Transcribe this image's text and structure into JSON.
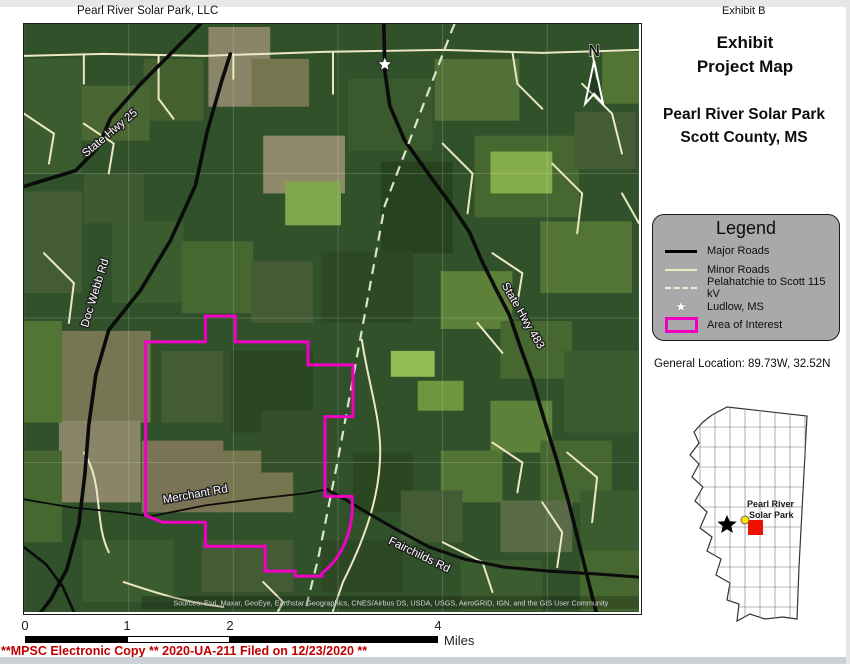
{
  "header": {
    "map_title": "Pearl River Solar Park, LLC",
    "exhibit_tag": "Exhibit B"
  },
  "panel": {
    "title_line1": "Exhibit",
    "title_line2": "Project Map",
    "subtitle_line1": "Pearl River Solar Park",
    "subtitle_line2": "Scott County, MS"
  },
  "legend": {
    "title": "Legend",
    "items": [
      {
        "label": "Major Roads",
        "symbol": "solid-black-line"
      },
      {
        "label": "Minor Roads",
        "symbol": "solid-cream-line"
      },
      {
        "label": "Pelahatchie to Scott 115 kV",
        "symbol": "dashed-pale-line"
      },
      {
        "label": "Ludlow, MS",
        "symbol": "white-star"
      },
      {
        "label": "Area of Interest",
        "symbol": "magenta-rectangle"
      }
    ]
  },
  "icons": {
    "star": "★"
  },
  "general_location": "General Location: 89.73W, 32.52N",
  "map": {
    "north_label": "N",
    "road_labels": {
      "state_hwy_25": "State Hwy 25",
      "doc_webb_rd": "Doc Webb Rd",
      "state_hwy_483": "State Hwy 483",
      "merchant_rd": "Merchant Rd",
      "fairchilds_rd": "Fairchilds Rd"
    },
    "attribution": "Sources: Esri, Maxar, GeoEye, Earthstar Geographics, CNES/Airbus DS, USDA, USGS, AeroGRID, IGN, and the GIS User Community"
  },
  "inset": {
    "label_line1": "Pearl River",
    "label_line2": "Solar Park"
  },
  "scale": {
    "ticks": [
      "0",
      "1",
      "2",
      "4"
    ],
    "unit": "Miles"
  },
  "footer": {
    "filing_text": "**MPSC Electronic Copy ** 2020-UA-211 Filed on 12/23/2020 **"
  },
  "colors": {
    "area_of_interest": "#F100C3",
    "legend_background": "#A9A9A9",
    "footer_red": "#C00000",
    "inset_highlight_red": "#EE1000",
    "inset_dot_yellow": "#FFE100"
  }
}
